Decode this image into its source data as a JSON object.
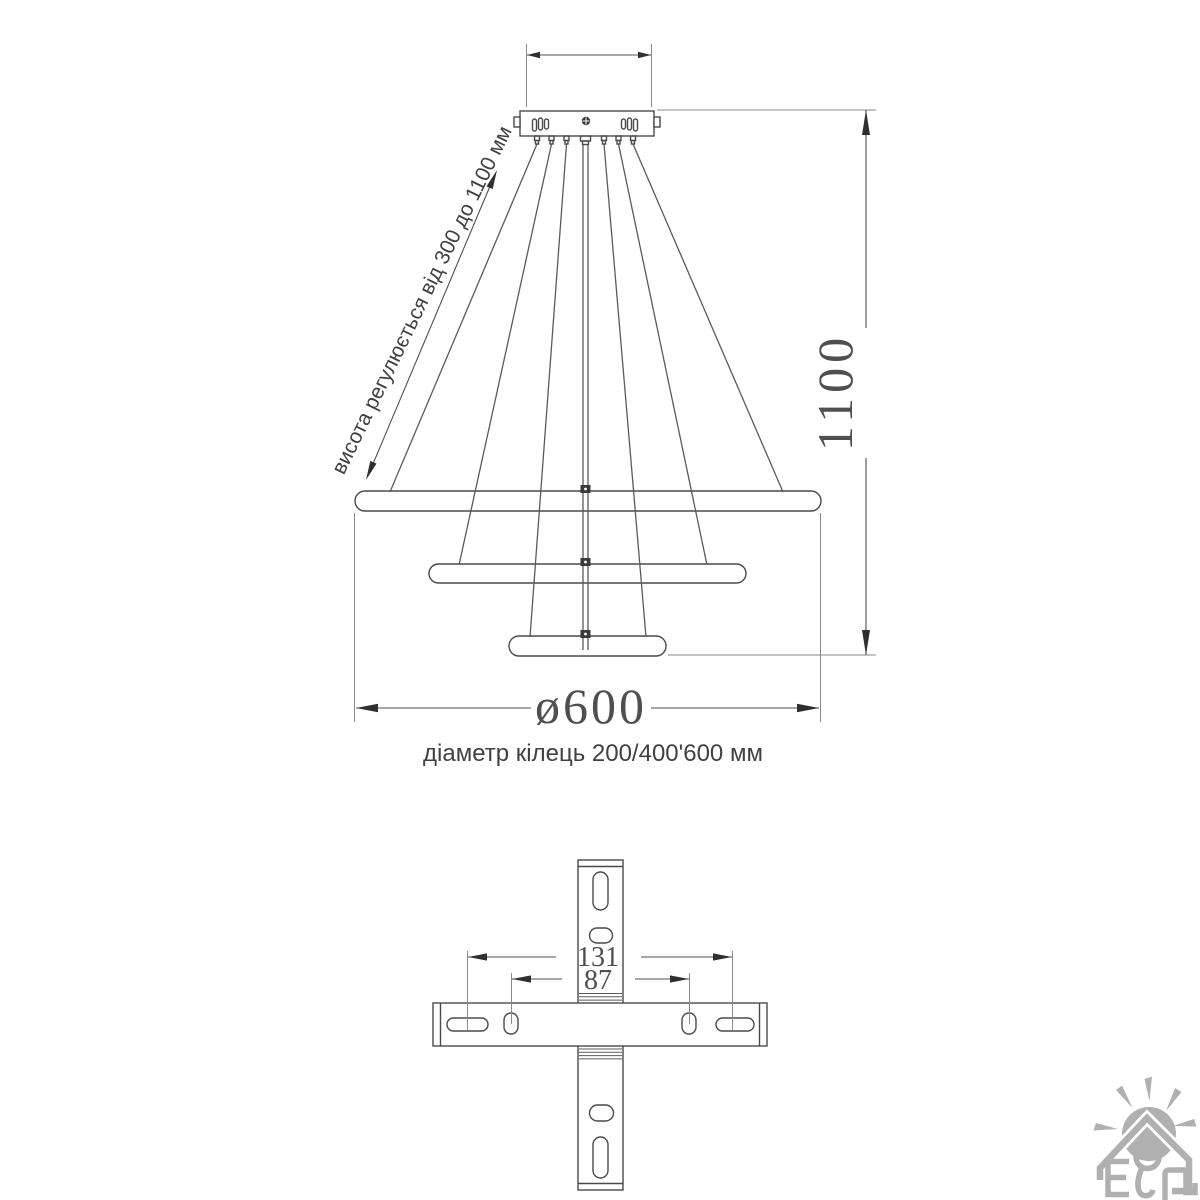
{
  "drawing": {
    "type": "pendant-chandelier-technical-drawing",
    "labels": {
      "height_note": "висота регулюється від 300 до 1100 мм",
      "height_value": "1100",
      "diameter_value": "ø600",
      "rings_caption": "діаметр кілець  200/400'600 мм",
      "bracket_outer": "131",
      "bracket_inner": "87"
    },
    "logo": {
      "name": "house-sun-logo",
      "letters": "ЕЛ"
    },
    "colors": {
      "background": "#ffffff",
      "line": "#4a4a4a",
      "dimension_line": "#4f4f4f",
      "extension_line": "#8a8a8a",
      "text": "#4f4f4f",
      "logo": "#a8a8a8"
    }
  }
}
